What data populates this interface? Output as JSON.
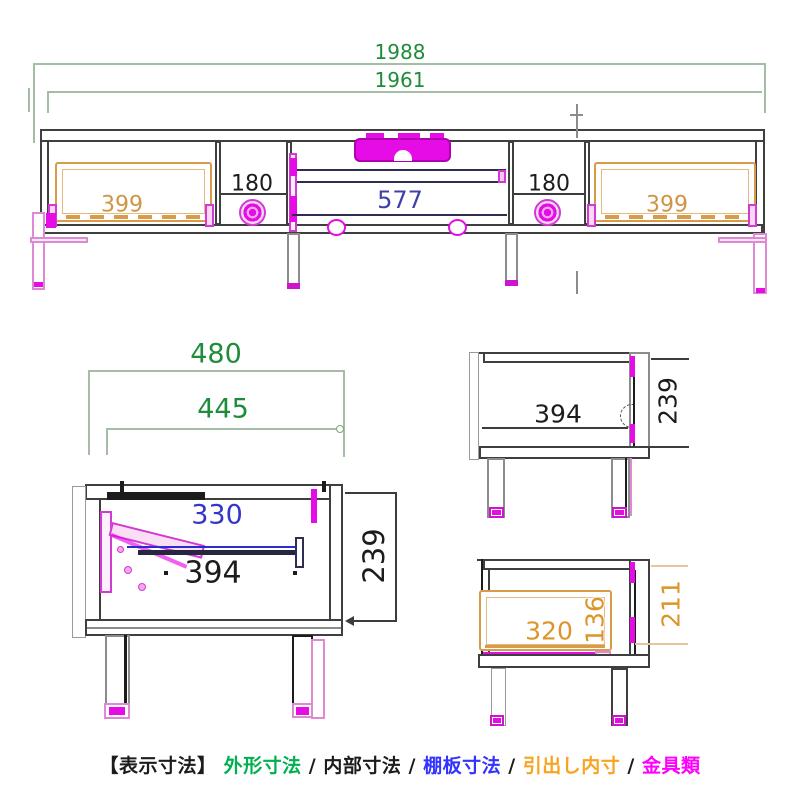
{
  "title": "TV board dimension drawing",
  "colors": {
    "outer_dims_green": "#1e8c3a",
    "internal_dims_black": "#1c1c1c",
    "shelf_dims_blue": "#3535c8",
    "shelf_dim_dark_blue": "#4040a8",
    "drawer_dims_orange": "#cf9544",
    "drawer_dims_orange_bright": "#dd9429",
    "hardware_magenta": "#e60ce6",
    "legend_green": "#00b050",
    "legend_blue": "#3333ff",
    "legend_orange": "#f7a421",
    "legend_magenta": "#ff00ff"
  },
  "front_view": {
    "dim_overall_width": "1988",
    "dim_inner_width": "1961",
    "dim_left_drawer_width": "399",
    "dim_left_gap_width": "180",
    "dim_shelf_width": "577",
    "dim_right_gap_width": "180",
    "dim_right_drawer_width": "399"
  },
  "left_side_view": {
    "dim_outer_depth": "480",
    "dim_inner_depth": "445",
    "dim_shelf_depth": "330",
    "dim_interior_depth": "394",
    "dim_interior_height": "239"
  },
  "open_side_view": {
    "dim_interior_depth": "394",
    "dim_interior_height": "239"
  },
  "drawer_side_view": {
    "dim_drawer_inner_depth": "320",
    "dim_drawer_inner_height": "136",
    "dim_interior_height": "211"
  },
  "legend": {
    "prefix": "【表示寸法】",
    "separator": "/",
    "items": [
      {
        "label": "外形寸法",
        "color": "#00b050"
      },
      {
        "label": "内部寸法",
        "color": "#1c1c1c"
      },
      {
        "label": "棚板寸法",
        "color": "#3333ff"
      },
      {
        "label": "引出し内寸",
        "color": "#f7a421"
      },
      {
        "label": "金具類",
        "color": "#ff00ff"
      }
    ]
  }
}
